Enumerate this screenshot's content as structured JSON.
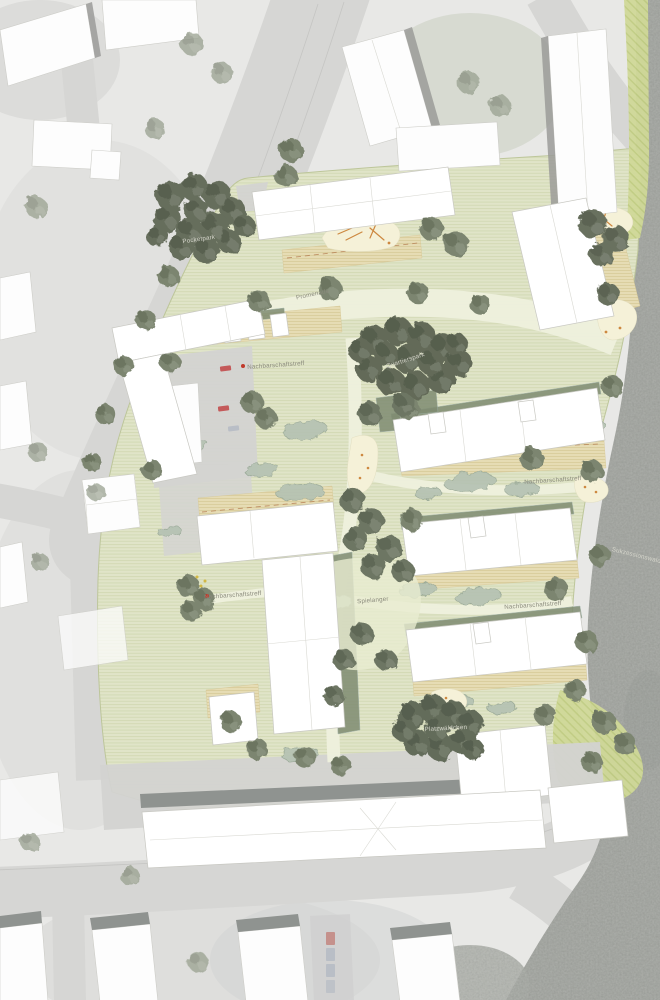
{
  "plan": {
    "labels": [
      {
        "id": "pocketpark",
        "text": "Pocketpark"
      },
      {
        "id": "promenade",
        "text": "Promenade"
      },
      {
        "id": "nachbarschaftstreff-1",
        "text": "Nachbarschaftstreff"
      },
      {
        "id": "quartierspark",
        "text": "Quartierspark"
      },
      {
        "id": "nachbarschaftstreff-2",
        "text": "Nachbarschaftstreff"
      },
      {
        "id": "nachbarschaftstreff-3",
        "text": "Nachbarschaftstreff"
      },
      {
        "id": "spielanger",
        "text": "Spielanger"
      },
      {
        "id": "nachbarschaftstreff-4",
        "text": "Nachbarschaftstreff"
      },
      {
        "id": "platzwaeldchen",
        "text": "Platzwäldchen"
      },
      {
        "id": "sukzessionswald",
        "text": "Sukzessionswald"
      }
    ],
    "colors": {
      "context_bg": "#e8e8e6",
      "road": "#d6d6d4",
      "site_lawn": "#e0e4c8",
      "building_new": "#ffffff",
      "building_outline": "#c8c8c2",
      "building_shadow": "#9b9b99",
      "tree_dark": "#666e5c",
      "tree_mid": "#7b856f",
      "tree_pale": "#99a18f",
      "shrub": "#b5c2b2",
      "hedge": "#7e8b71",
      "terrace": "#e6dcb4",
      "play_area": "#f5f1d8",
      "play_equipment": "#cd8840",
      "marker_red": "#c0392b",
      "forest_gray": "#b0b2ae",
      "meadow_strip": "#cfd898",
      "label_gray": "#8a8a7c",
      "label_light": "#d6d6cc"
    }
  }
}
